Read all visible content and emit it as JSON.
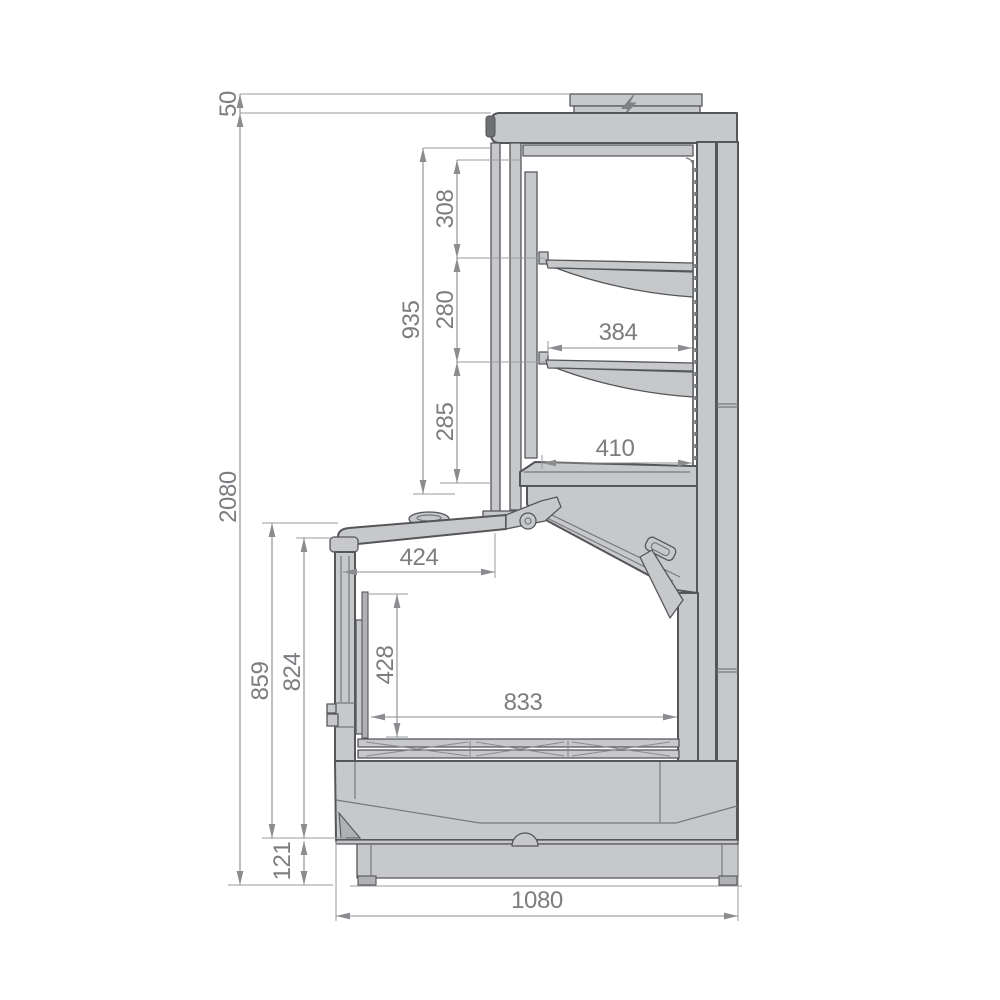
{
  "drawing": {
    "type": "technical-drawing",
    "view": "side-cross-section",
    "subject": "refrigerated display cabinet",
    "units": "mm",
    "dimensions": {
      "electrical_box_height": "50",
      "overall_height": "2080",
      "upper_opening_height": "935",
      "upper_gap_top": "308",
      "upper_gap_middle": "280",
      "upper_gap_bottom": "285",
      "shelf_depth": "384",
      "bottom_shelf_depth": "410",
      "lid_depth": "424",
      "well_height": "428",
      "well_depth": "833",
      "front_height_overall": "859",
      "front_height_body": "824",
      "plinth_height": "121",
      "overall_depth": "1080"
    },
    "icons": {
      "electrical": "lightning-bolt"
    },
    "colors": {
      "background": "#ffffff",
      "body_fill": "#c7c8ca",
      "outline": "#55565a",
      "detail_line": "#77787a",
      "dimension_line": "#8b8c8f",
      "dimension_text": "#7c7d80"
    }
  }
}
